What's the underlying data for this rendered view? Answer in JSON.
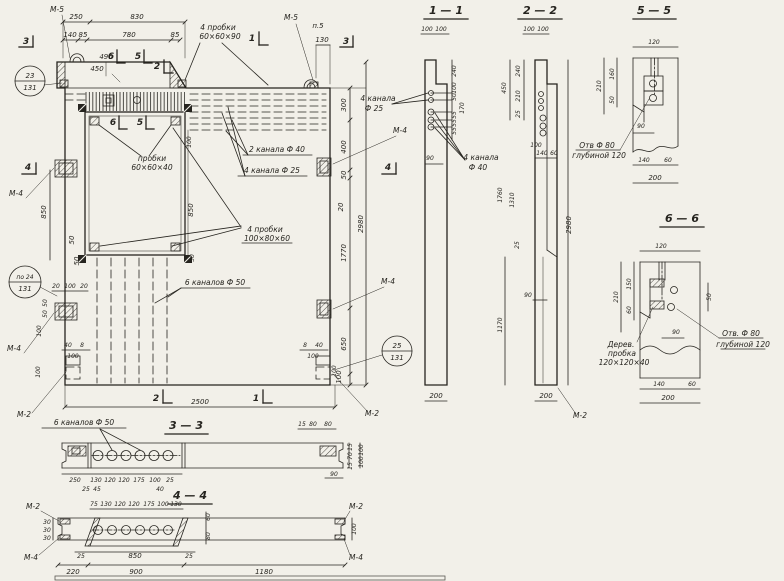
{
  "palette": {
    "paper": "#f2f0e9",
    "ink": "#26241f"
  },
  "views": {
    "main": {
      "labels": {
        "m5_left": "М-5",
        "m5_right": "М-5",
        "p5": "п.5",
        "m4_left_top": "М-4",
        "m4_left_bot": "М-4",
        "m2_left": "М-2",
        "m4_right_top": "М-4",
        "m4_right_bot": "М-4",
        "m2_right": "М-2",
        "probki_top_1": "4 пробки",
        "probki_top_2": "60×60×90",
        "probki_win_1": "пробки",
        "probki_win_2": "60×60×40",
        "probki_big_1": "4 пробки",
        "probki_big_2": "100×80×60",
        "kanala_f40": "2 канала Ф 40",
        "kanala_f25": "4 канала Ф 25",
        "kanalov_f50": "6 каналов Ф 50",
        "kanala_f25_r1": "4 канала",
        "kanala_f25_r2": "Ф 25"
      },
      "marks": {
        "m1_top": "1",
        "m2_top": "2",
        "m3_left": "3",
        "m3_right": "3",
        "m4_left": "4",
        "m4_right": "4",
        "m5_top": "5",
        "m6_top": "6",
        "m5_win": "5",
        "m6_win": "6",
        "m1_bot": "1",
        "m2_bot": "2"
      },
      "circles": {
        "c1_top": "23",
        "c1_bot": "131",
        "c2_top": "по 24",
        "c2_bot": "131",
        "c3_top": "25",
        "c3_bot": "131"
      },
      "dims": {
        "d250": "250",
        "d830": "830",
        "d140": "140",
        "d85a": "85",
        "d780": "780",
        "d85b": "85",
        "d490": "490",
        "d450": "450",
        "d130": "130",
        "d300": "300",
        "d400": "400",
        "d50a": "50",
        "d20a": "20",
        "d1770": "1770",
        "d650": "650",
        "d100a": "100",
        "d2980": "2980",
        "d850a": "850",
        "d50b": "50",
        "d50c": "50",
        "d20b": "20",
        "d100b": "100",
        "d20c": "20",
        "d50d": "50",
        "d50e": "50",
        "d100c": "100",
        "d40a": "40",
        "d8a": "8",
        "d100d": "100",
        "d100e": "100",
        "d8b": "8",
        "d40b": "40",
        "d100f": "100",
        "d100g": "100",
        "d2500": "2500",
        "d100h": "100",
        "d850b": "850",
        "d50f": "50"
      }
    },
    "s11": {
      "title": "1 — 1",
      "labels": {
        "k40_1": "4 канала",
        "k40_2": "Ф 40"
      },
      "dims": {
        "t100a": "100",
        "t100b": "100",
        "d240": "240",
        "d100": "100",
        "d50": "50",
        "d170": "170",
        "d55a": "55",
        "d55b": "55",
        "d55c": "55",
        "d90": "90",
        "d200": "200"
      }
    },
    "s22": {
      "title": "2 — 2",
      "labels": {
        "m2": "М-2"
      },
      "dims": {
        "t100a": "100",
        "t100b": "100",
        "d450": "450",
        "d240": "240",
        "d210": "210",
        "d25a": "25",
        "d100": "100",
        "d140": "140",
        "d60": "60",
        "d1760": "1760",
        "d1310": "1310",
        "d25b": "25",
        "d90": "90",
        "d1170": "1170",
        "d2980": "2980",
        "d200": "200"
      }
    },
    "s55": {
      "title": "5 — 5",
      "labels": {
        "otv1": "Отв Ф 80",
        "otv2": "глубиной 120"
      },
      "dims": {
        "d120": "120",
        "d160": "160",
        "d210": "210",
        "d50": "50",
        "d90": "90",
        "d140": "140",
        "d60": "60",
        "d200": "200"
      }
    },
    "s66": {
      "title": "6 — 6",
      "labels": {
        "otv1": "Отв. Ф 80",
        "otv2": "глубиной 120",
        "der1": "Дерев.",
        "der2": "пробка",
        "der3": "120×120×40"
      },
      "dims": {
        "d120": "120",
        "d150": "150",
        "d210": "210",
        "d60a": "60",
        "d50": "50",
        "d90": "90",
        "d140": "140",
        "d60b": "60",
        "d200": "200"
      }
    },
    "s33": {
      "title": "3 — 3",
      "label": "6 каналов Ф 50",
      "dims": {
        "d15a": "15",
        "d80a": "80",
        "d80b": "80",
        "d15b": "15",
        "d70": "70",
        "d15c": "15",
        "d100a": "100",
        "d100b": "100",
        "d90": "90",
        "d250": "250",
        "d25a": "25",
        "d45": "45",
        "d130": "130",
        "d120a": "120",
        "d120b": "120",
        "d175": "175",
        "d100c": "100",
        "d25b": "25",
        "d40": "40"
      }
    },
    "s44": {
      "title": "4 — 4",
      "labels": {
        "m2l": "М-2",
        "m2r": "М-2",
        "m4l": "М-4",
        "m4r": "М-4"
      },
      "dims": {
        "d75": "75",
        "d130a": "130",
        "d120a": "120",
        "d120b": "120",
        "d175": "175",
        "d100a": "100",
        "d130b": "130",
        "d60": "60",
        "d80": "80",
        "d100b": "100",
        "d30a": "30",
        "d30b": "30",
        "d30c": "30",
        "d25a": "25",
        "d850": "850",
        "d25b": "25",
        "d220": "220",
        "d900": "900",
        "d1180": "1180"
      }
    }
  }
}
